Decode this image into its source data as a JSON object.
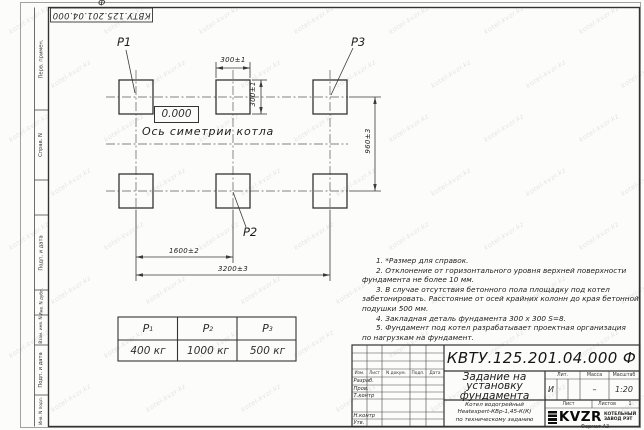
{
  "sheet": {
    "designation_top_rotated": "КВТУ.125.201.04.000  Ф",
    "format_label": "Формат А3",
    "watermark_text": "kotel-kvzr.kz",
    "left_margin_labels": [
      "Перв. примен.",
      "Справ. N",
      "Подп. и дата",
      "Инв. N дубл.",
      "Взам. инв. N",
      "Подп. и дата",
      "Инв. N подл."
    ]
  },
  "drawing": {
    "point_labels": {
      "p1": "P1",
      "p2": "P2",
      "p3": "P3"
    },
    "elevation_mark": "0.000",
    "axis_label": "Ось симетрии котла",
    "dimensions": {
      "pad_width": "300±1",
      "pad_height": "300±1",
      "row_spacing": "960±3",
      "column_spacing": "1600±2",
      "overall_width": "3200±3"
    }
  },
  "notes": {
    "lines": [
      "1. *Размер для справок.",
      "2. Отклонение от горизонтального уровня верхней поверхности",
      "фундамента не более 10 мм.",
      "3. В случае отсутствия бетонного пола площадку под котел",
      "забетонировать. Расстояние от осей крайних колонн до края бетонной",
      "подушки 500 мм.",
      "4. Закладная деталь фундамента  300 x 300  S=8.",
      "5. Фундамент под котел разрабатывает проектная организация",
      "по нагрузкам на фундамент."
    ]
  },
  "load_table": {
    "headers": [
      {
        "name": "P",
        "sub": "1"
      },
      {
        "name": "P",
        "sub": "2"
      },
      {
        "name": "P",
        "sub": "3"
      }
    ],
    "values": [
      "400 кг",
      "1000 кг",
      "500 кг"
    ]
  },
  "title_block": {
    "designation": "КВТУ.125.201.04.000  Ф",
    "doc_title_lines": [
      "Задание на",
      "установку",
      "фундамента"
    ],
    "change_header": [
      "Изм.",
      "Лист",
      "N докум.",
      "Подп.",
      "Дата"
    ],
    "signature_rows": [
      "Разраб.",
      "Пров.",
      "Т.контр",
      "Н.контр",
      "Утв."
    ],
    "lit_label": "Лит.",
    "lit_value": "И",
    "mass_label": "Масса",
    "mass_value": "–",
    "scale_label": "Масштаб",
    "scale_value": "1:20",
    "sheet_label": "Лист",
    "sheets_label": "Листов",
    "sheets_value": "1",
    "product_lines": [
      "Котел водогрейный",
      "Heatexpert-КВр-1,45-К(К)",
      "по техническому заданию"
    ],
    "logo_text": "KVZR",
    "company_lines": [
      "КОТЕЛЬНЫЙ",
      "ЗАВОД РЭТ"
    ]
  }
}
